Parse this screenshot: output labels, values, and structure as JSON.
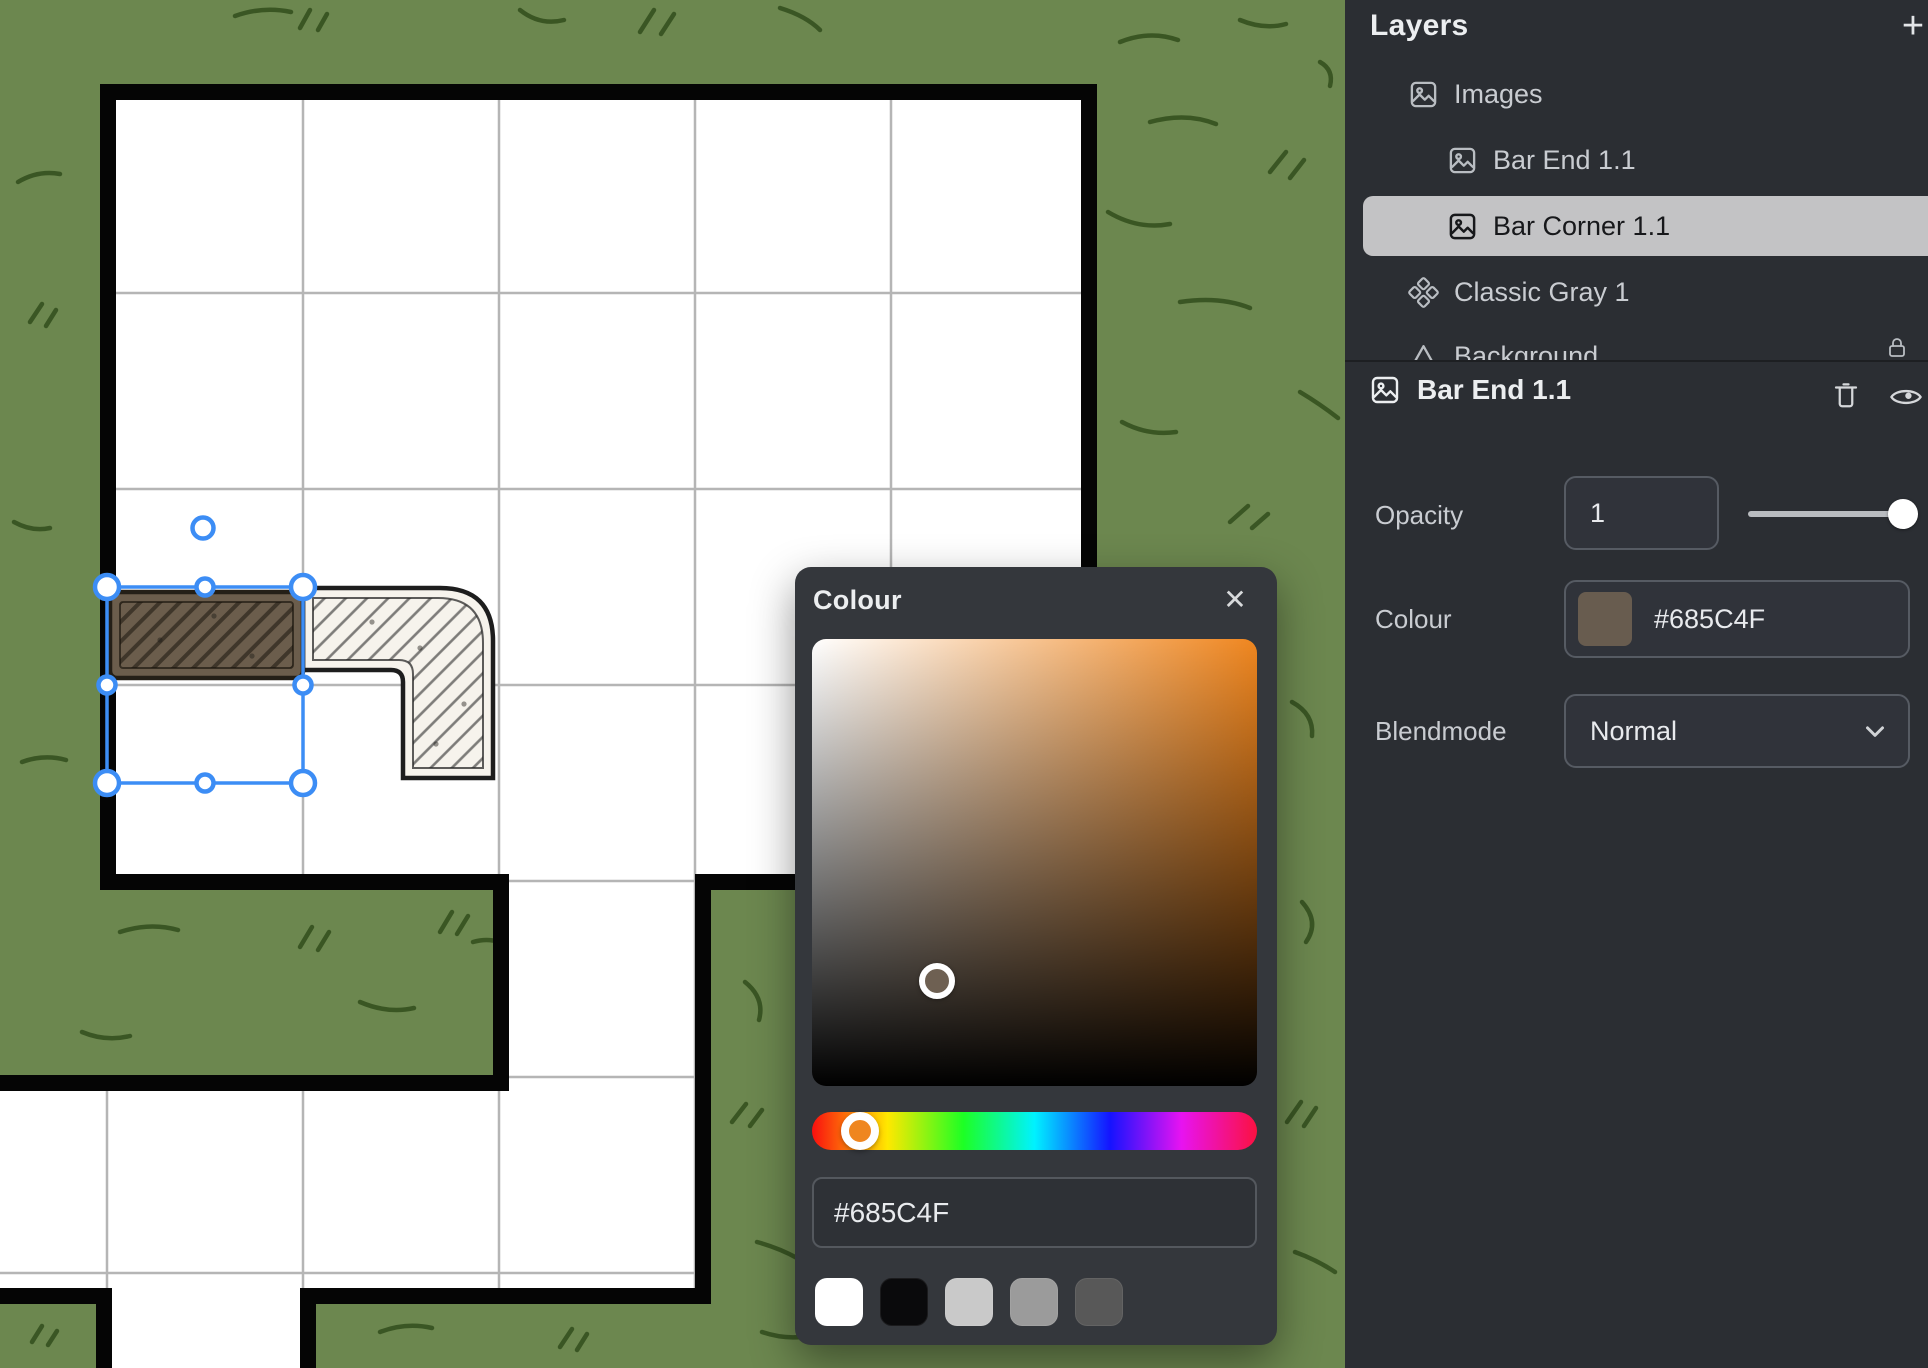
{
  "colors": {
    "grass": "#6c874f",
    "scribble": "#35511f",
    "floor": "#ffffff",
    "grid": "#b5b5b5",
    "wall": "#050505",
    "wall_shadow": "#c5c5c5",
    "selection": "#3c8df5",
    "bar_end": "#6b5d4c",
    "bar_corner": "#f6f3ec",
    "panel_bg": "#2b2e33",
    "panel_text": "#c9ccd1",
    "panel_heading": "#eceef0",
    "row_highlight": "#c3c3c5",
    "row_highlight_text": "#17181b",
    "control_bg": "#30333a",
    "control_border": "#565b63",
    "control_text": "#e8eaed",
    "dialog_bg": "#34373c",
    "accent_orange": "#ef861f",
    "sv_cursor_sample": "#6e6052",
    "slider_track": "#b9bcc0",
    "slider_knob": "#ffffff"
  },
  "sidebar": {
    "title": "Layers",
    "add_label": "+",
    "layers": [
      {
        "label": "Images"
      },
      {
        "label": "Bar End 1.1"
      },
      {
        "label": "Bar Corner 1.1"
      },
      {
        "label": "Classic Gray 1"
      },
      {
        "label": "Background"
      }
    ],
    "properties": {
      "title": "Bar End 1.1",
      "opacity_label": "Opacity",
      "opacity_value": "1",
      "colour_label": "Colour",
      "colour_value": "#685C4F",
      "blend_label": "Blendmode",
      "blend_value": "Normal"
    }
  },
  "color_dialog": {
    "title": "Colour",
    "close_label": "✕",
    "hex_value": "#685C4F",
    "swatches": [
      "#ffffff",
      "#0a0a0c",
      "#c9c9c9",
      "#9b9b9b",
      "#585858"
    ]
  }
}
